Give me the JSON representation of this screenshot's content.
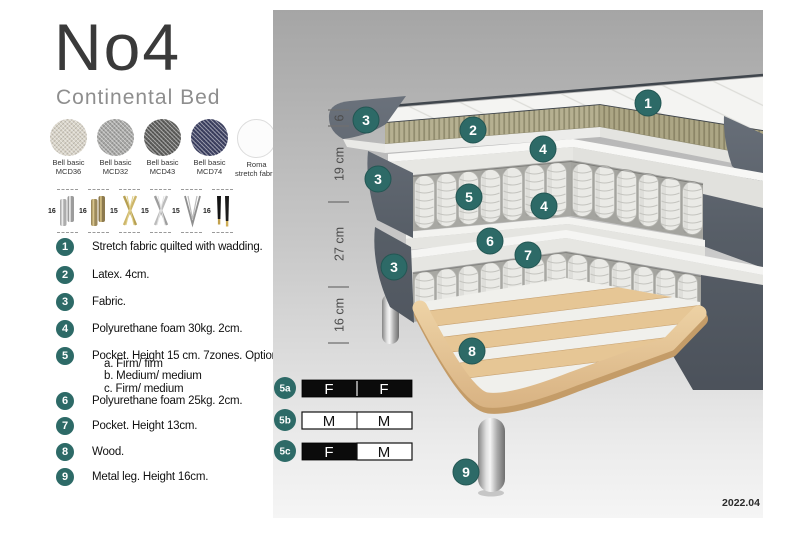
{
  "product": {
    "name": "No4",
    "type": "Continental Bed"
  },
  "fabrics": [
    {
      "name": "Bell basic",
      "code": "MCD36",
      "color": "#d8d3c7"
    },
    {
      "name": "Bell basic",
      "code": "MCD32",
      "color": "#a7a7a5"
    },
    {
      "name": "Bell basic",
      "code": "MCD43",
      "color": "#5f5f5d"
    },
    {
      "name": "Bell basic",
      "code": "MCD74",
      "color": "#3e4263"
    },
    {
      "name": "Roma",
      "code": "stretch fabric",
      "color": "#fcfcfc"
    }
  ],
  "legs": [
    {
      "height": "16",
      "type": "cylinder-silver"
    },
    {
      "height": "16",
      "type": "cylinder-brass"
    },
    {
      "height": "15",
      "type": "cross-gold"
    },
    {
      "height": "15",
      "type": "cross-silver"
    },
    {
      "height": "15",
      "type": "hairpin-metal"
    },
    {
      "height": "16",
      "type": "tapered-black-gold"
    }
  ],
  "features": [
    {
      "num": "1",
      "text": "Stretch fabric quilted with wadding."
    },
    {
      "num": "2",
      "text": "Latex. 4cm."
    },
    {
      "num": "3",
      "text": "Fabric."
    },
    {
      "num": "4",
      "text": "Polyurethane foam 30kg. 2cm."
    },
    {
      "num": "5",
      "text": "Pocket. Height 15 cm. 7zones. Option:",
      "options": [
        "a. Firm/ firm",
        "b. Medium/ medium",
        "c. Firm/ medium"
      ]
    },
    {
      "num": "6",
      "text": "Polyurethane foam 25kg. 2cm."
    },
    {
      "num": "7",
      "text": "Pocket. Height 13cm."
    },
    {
      "num": "8",
      "text": "Wood."
    },
    {
      "num": "9",
      "text": "Metal leg. Height 16cm."
    }
  ],
  "diagram": {
    "dimensions": [
      "6",
      "19 cm",
      "27 cm",
      "16 cm"
    ],
    "callouts": [
      {
        "label": "3"
      },
      {
        "label": "2"
      },
      {
        "label": "1"
      },
      {
        "label": "4"
      },
      {
        "label": "3"
      },
      {
        "label": "5"
      },
      {
        "label": "4"
      },
      {
        "label": "6"
      },
      {
        "label": "7"
      },
      {
        "label": "3"
      },
      {
        "label": "8"
      },
      {
        "label": "9"
      }
    ],
    "firmness": [
      {
        "id": "5a",
        "left": "F",
        "right": "F",
        "left_dark": true,
        "right_dark": true
      },
      {
        "id": "5b",
        "left": "M",
        "right": "M",
        "left_dark": false,
        "right_dark": false
      },
      {
        "id": "5c",
        "left": "F",
        "right": "M",
        "left_dark": true,
        "right_dark": false
      }
    ],
    "version": "2022.04"
  },
  "colors": {
    "accent": "#2d6a67",
    "bed_fabric": "#575e67",
    "latex": "#b6b091",
    "wood": "#e2c391",
    "panel_top": "#a5a5a5"
  }
}
